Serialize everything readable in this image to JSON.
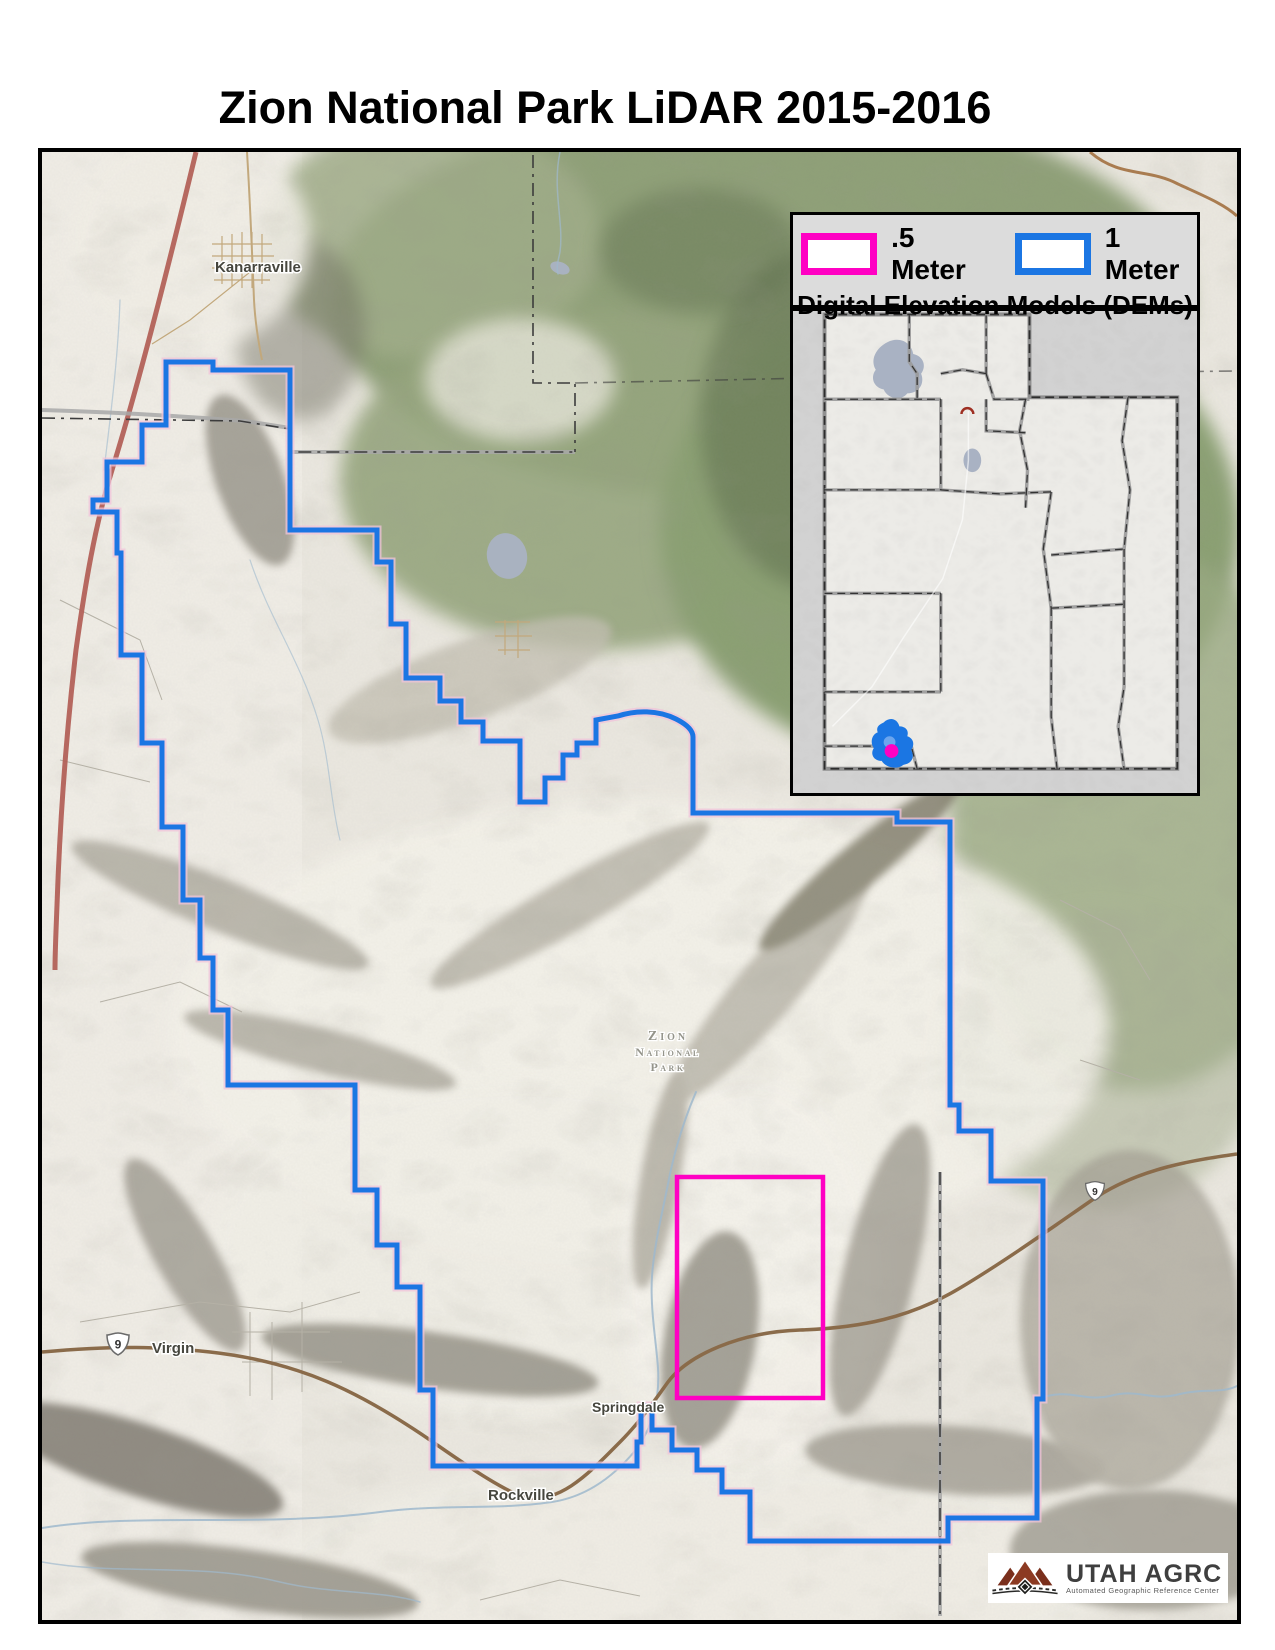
{
  "page": {
    "title": "Zion National Park LiDAR 2015-2016"
  },
  "colors": {
    "half_meter": "#ff00c3",
    "one_meter": "#1b76e3",
    "frame": "#000000",
    "legend_bg": "#dcdcdc",
    "terrain_green": "#8fa078",
    "logo_maroon": "#8c3a22"
  },
  "legend": {
    "half_meter_label": ".5 Meter",
    "one_meter_label": "1 Meter",
    "subtitle": "Digital Elevation Models (DEMs)"
  },
  "map_labels": {
    "kanarraville": "Kanarraville",
    "virgin": "Virgin",
    "springdale": "Springdale",
    "rockville": "Rockville",
    "park_line1": "Zion",
    "park_line2": "National",
    "park_line3": "Park",
    "route_shield_west": "9",
    "route_shield_east": "9"
  },
  "logo": {
    "name": "UTAH AGRC",
    "tagline": "Automated Geographic Reference Center"
  }
}
